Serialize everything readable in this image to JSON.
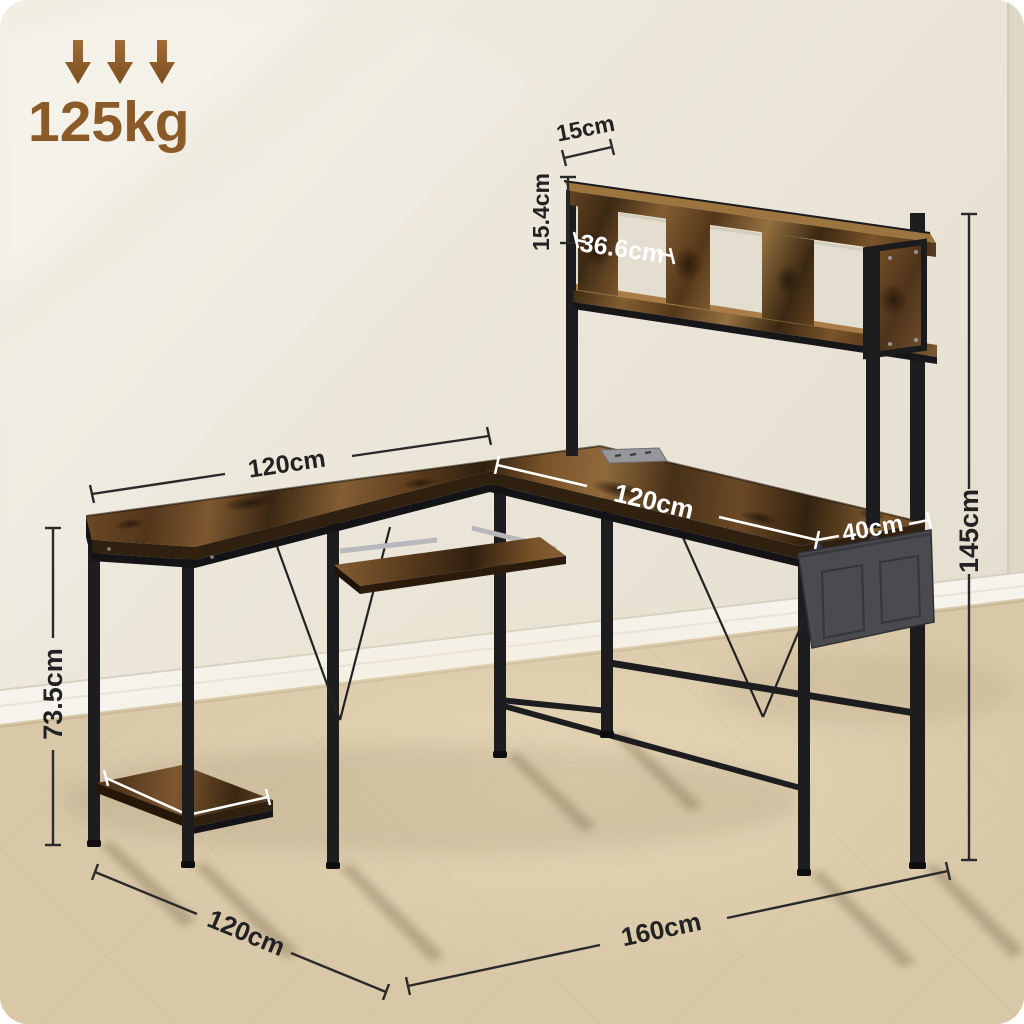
{
  "image": {
    "type": "product-dimension-diagram",
    "subject": "L-shaped computer desk with hutch, rustic brown wood top and black steel frame, keyboard tray, side storage bag and bottom shelf"
  },
  "load_badge": {
    "value": "125kg",
    "icon": "down-arrow-icon"
  },
  "dimensions": {
    "hutch_depth": "15cm",
    "hutch_height": "15.4cm",
    "cubby_width": "36.6cm",
    "left_top_length": "120cm",
    "right_top_length": "120cm",
    "right_top_depth": "40cm",
    "overall_height": "145cm",
    "desktop_height": "73.5cm",
    "floor_left_depth": "120cm",
    "floor_right_length": "160cm"
  },
  "colors": {
    "accent_brown": "#8a5a28",
    "wood": "#7a5329",
    "wood_dark": "#30200f",
    "steel_frame": "#1d1d20",
    "wall": "#ebe6da",
    "baseboard": "#f5f3ec",
    "floor": "#d9c8a8",
    "bag": "#4a4a4f",
    "dim_line_dark": "#2a2a2a",
    "dim_line_light": "#ffffff"
  }
}
